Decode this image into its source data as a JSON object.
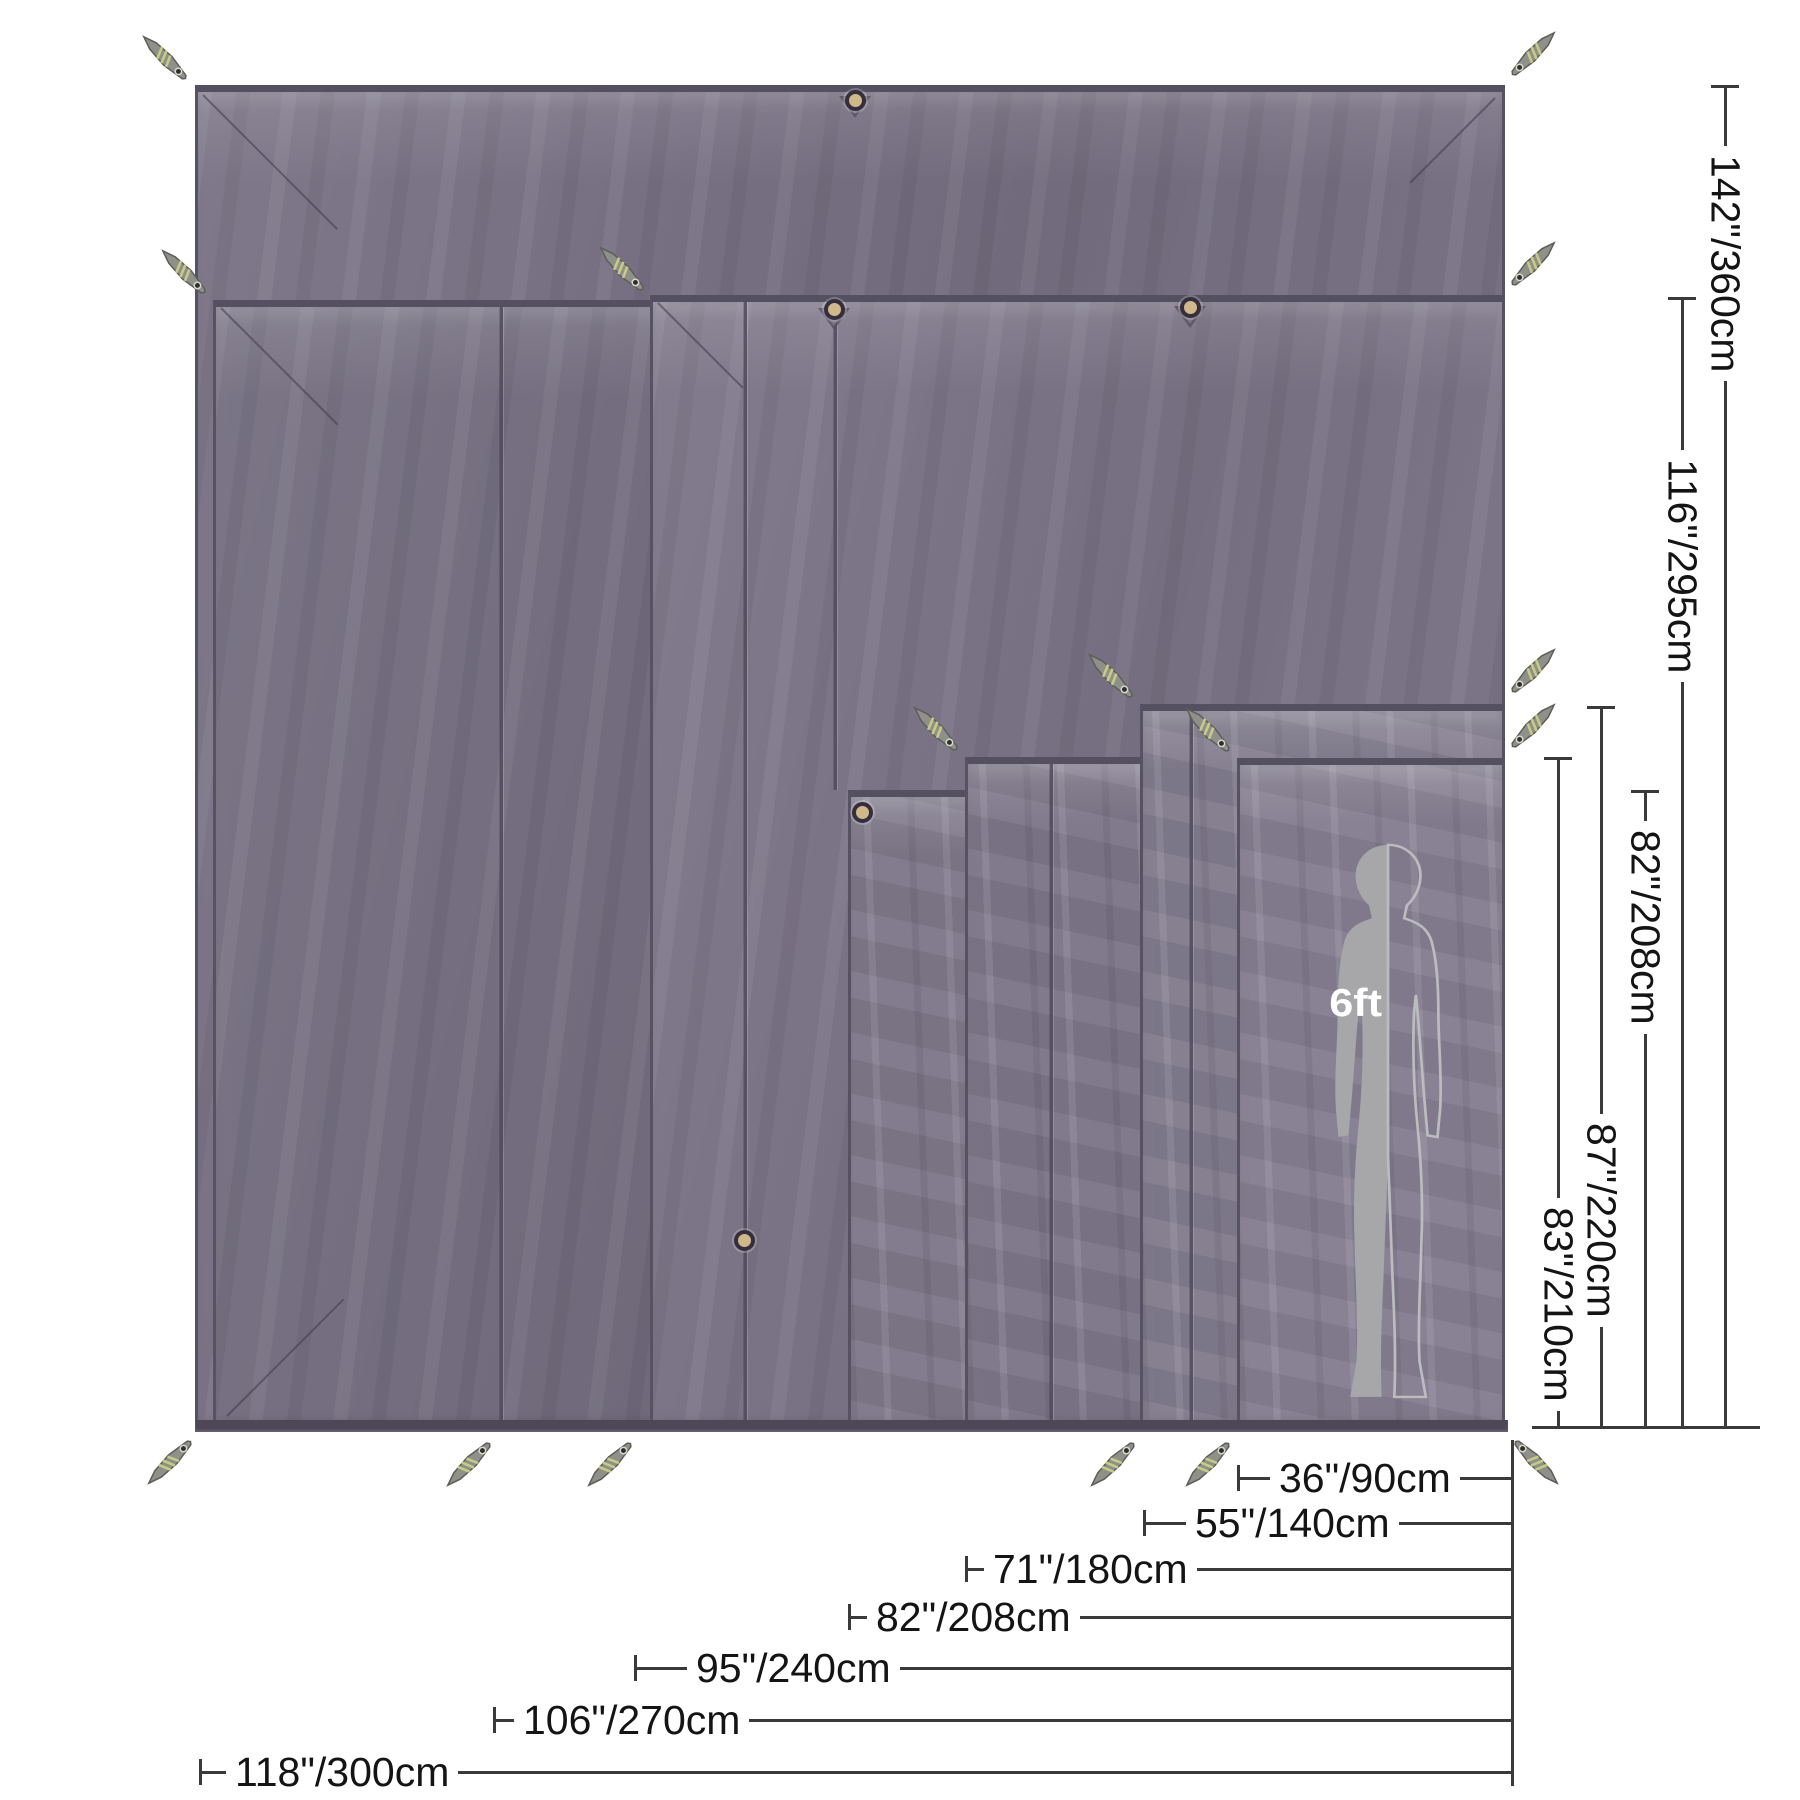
{
  "person": {
    "label": "6ft"
  },
  "bottom_dimensions": [
    {
      "label": "36\"/90cm"
    },
    {
      "label": "55\"/140cm"
    },
    {
      "label": "71\"/180cm"
    },
    {
      "label": "82\"/208cm"
    },
    {
      "label": "95\"/240cm"
    },
    {
      "label": "106\"/270cm"
    },
    {
      "label": "118\"/300cm"
    }
  ],
  "right_dimensions": [
    {
      "label": "142\"/360cm"
    },
    {
      "label": "116\"/295cm"
    },
    {
      "label": "82\"/208cm"
    },
    {
      "label": "87\"/220cm"
    },
    {
      "label": "83\"/210cm"
    }
  ],
  "colors": {
    "fabric": "#7a7385",
    "fabric_dark_edge": "#575164",
    "dimension_line": "#3a3a3a",
    "person_solid": "#a7a7a9",
    "person_outline": "#bcbcbe",
    "person_label": "#ffffff"
  }
}
